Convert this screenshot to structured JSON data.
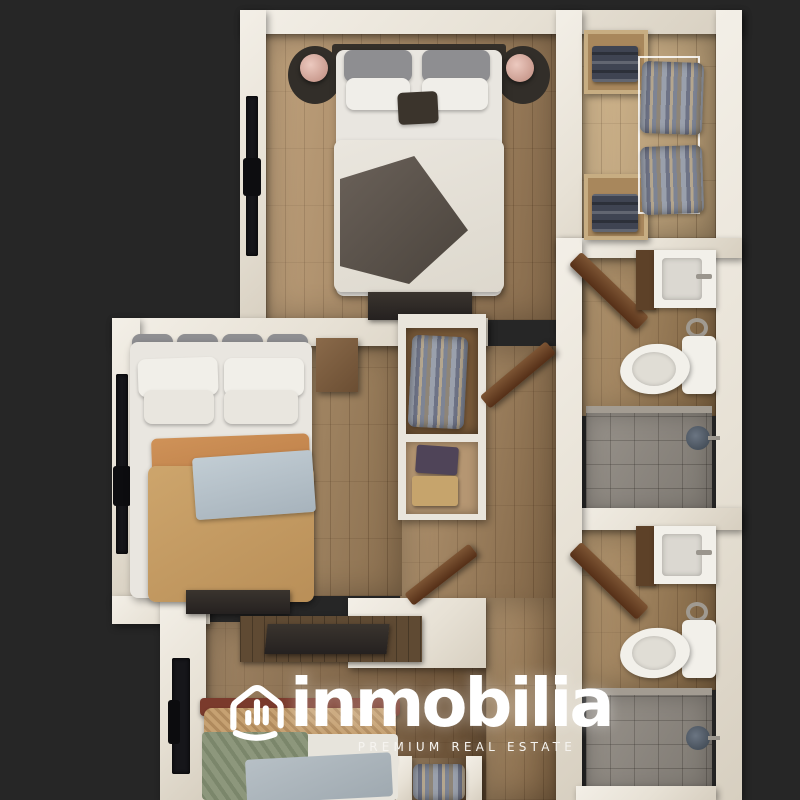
{
  "branding": {
    "name": "inmobilia",
    "tagline": "PREMIUM REAL ESTATE",
    "logo_icon": "house-bar-chart-smile-icon",
    "logo_color": "#ffffff"
  },
  "colors": {
    "background": "#262626",
    "walls": "#eae4d9",
    "wood_floor": "#a8855e",
    "closet_floor": "#c9aa7e",
    "hallway_floor": "#9c7a54",
    "dark_wood_panel": "#5f4a33",
    "shower_tile": "#8f8981",
    "lamp_accent": "#d4a89d",
    "duvet_orange": "#c89e65",
    "duvet_green": "#8d977c",
    "blanket_blue": "#b7c3cb",
    "towel_navy": "#3f4452"
  }
}
